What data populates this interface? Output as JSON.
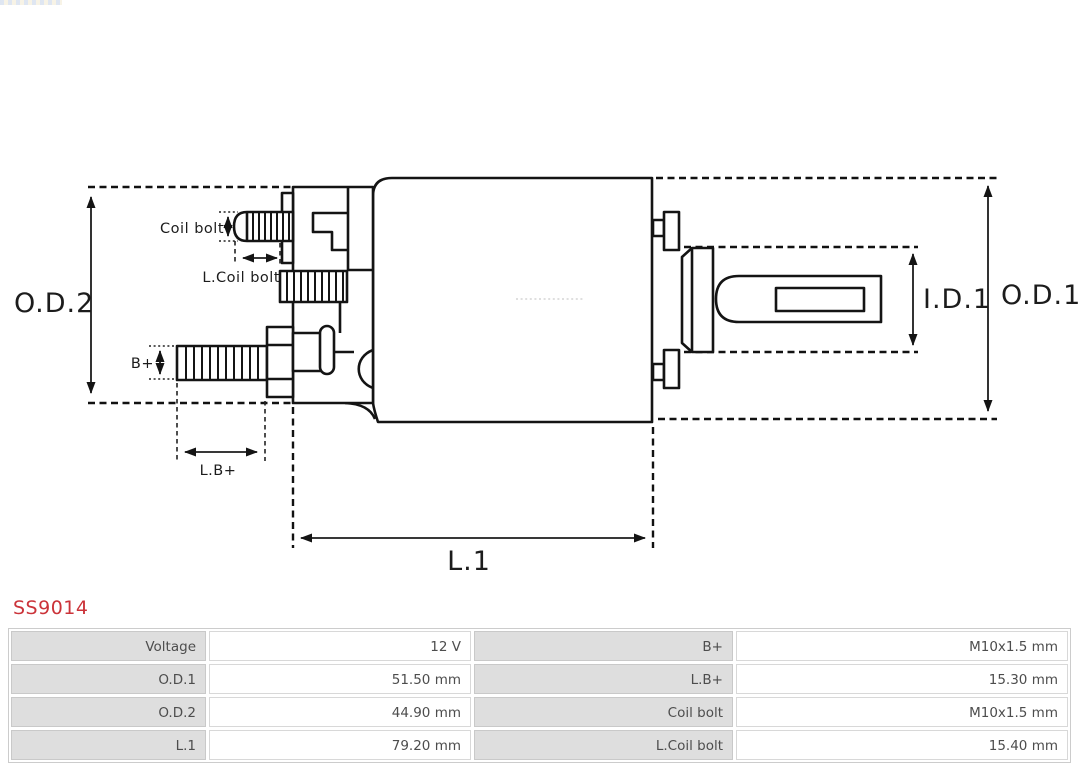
{
  "product_code": {
    "text": "SS9014",
    "color": "#cb3339"
  },
  "diagram": {
    "dimension_labels": {
      "od2": "O.D.2",
      "od1": "O.D.1",
      "id1": "I.D.1",
      "l1": "L.1",
      "coil_bolt": "Coil bolt",
      "l_coil_bolt": "L.Coil bolt",
      "b_plus": "B+",
      "l_b_plus": "L.B+"
    }
  },
  "spec_table": {
    "rows": [
      {
        "c0": "Voltage",
        "c1": "12 V",
        "c2": "B+",
        "c3": "M10x1.5 mm"
      },
      {
        "c0": "O.D.1",
        "c1": "51.50 mm",
        "c2": "L.B+",
        "c3": "15.30 mm"
      },
      {
        "c0": "O.D.2",
        "c1": "44.90 mm",
        "c2": "Coil bolt",
        "c3": "M10x1.5 mm"
      },
      {
        "c0": "L.1",
        "c1": "79.20 mm",
        "c2": "L.Coil bolt",
        "c3": "15.40 mm"
      }
    ]
  }
}
